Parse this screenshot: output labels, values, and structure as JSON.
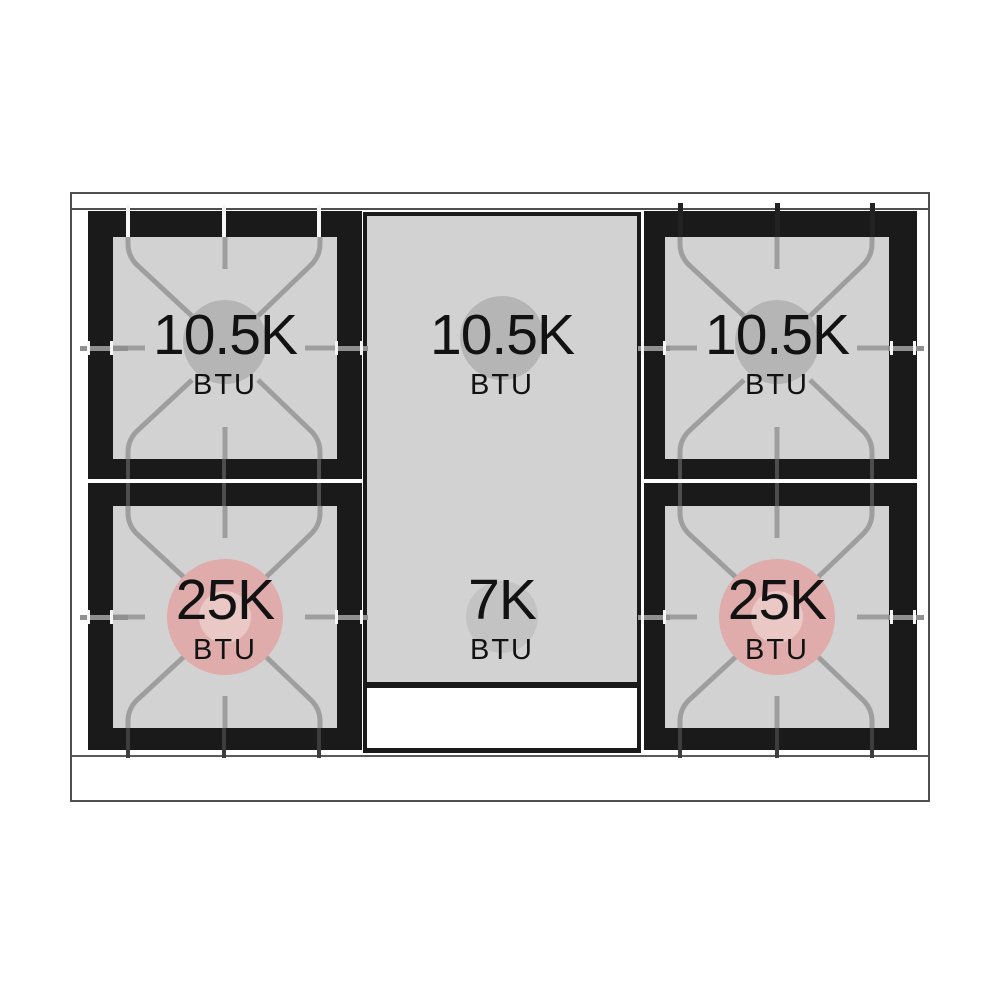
{
  "diagram": {
    "type": "gas-range-cooktop-burner-layout"
  },
  "burners": {
    "top_left": {
      "value": "10.5K",
      "unit": "BTU",
      "power": "standard"
    },
    "top_center": {
      "value": "10.5K",
      "unit": "BTU",
      "power": "standard"
    },
    "top_right": {
      "value": "10.5K",
      "unit": "BTU",
      "power": "standard"
    },
    "bottom_left": {
      "value": "25K",
      "unit": "BTU",
      "power": "high"
    },
    "bottom_center": {
      "value": "7K",
      "unit": "BTU",
      "power": "standard"
    },
    "bottom_right": {
      "value": "25K",
      "unit": "BTU",
      "power": "high"
    }
  },
  "colors": {
    "standard_burner_circle": "#b5b5b5",
    "small_burner_circle": "#c3c3c3",
    "high_power_burner_circle": "#dfabab",
    "high_power_burner_inner": "#e9c8c6",
    "surface_gray": "#d2d2d2",
    "frame_black": "#1a1a1a",
    "grate_line_gray": "#9e9e9e"
  }
}
